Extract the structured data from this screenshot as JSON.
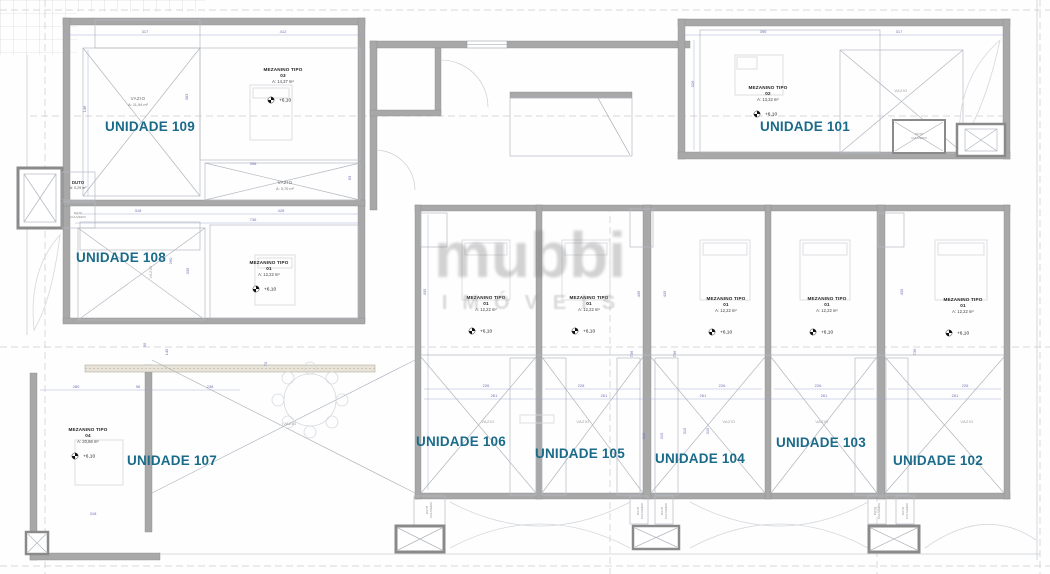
{
  "watermark": {
    "brand": "mubbi",
    "sub": "IMÓVEIS"
  },
  "units": [
    {
      "name": "UNIDADE 109"
    },
    {
      "name": "UNIDADE 101"
    },
    {
      "name": "UNIDADE 108"
    },
    {
      "name": "UNIDADE 107"
    },
    {
      "name": "UNIDADE 106"
    },
    {
      "name": "UNIDADE 105"
    },
    {
      "name": "UNIDADE 104"
    },
    {
      "name": "UNIDADE 103"
    },
    {
      "name": "UNIDADE 102"
    }
  ],
  "mezzanines": [
    {
      "title": "MEZANINO TIPO",
      "num": "03",
      "area": "A: 14,37 m²",
      "level": "+6,10"
    },
    {
      "title": "MEZANINO TIPO",
      "num": "02",
      "area": "A: 13,32 m²",
      "level": "+6,10"
    },
    {
      "title": "MEZANINO TIPO",
      "num": "01",
      "area": "A: 12,22 m²",
      "level": "+6,10"
    },
    {
      "title": "MEZANINO TIPO",
      "num": "04",
      "area": "A: 20,86 m²",
      "level": "+6,10"
    },
    {
      "title": "MEZANINO TIPO",
      "num": "01",
      "area": "A: 12,22 m²",
      "level": "+6,10"
    },
    {
      "title": "MEZANINO TIPO",
      "num": "01",
      "area": "A: 12,22 m²",
      "level": "+6,10"
    },
    {
      "title": "MEZANINO TIPO",
      "num": "01",
      "area": "A: 12,22 m²",
      "level": "+6,10"
    },
    {
      "title": "MEZANINO TIPO",
      "num": "01",
      "area": "A: 12,22 m²",
      "level": "+6,10"
    },
    {
      "title": "MEZANINO TIPO",
      "num": "01",
      "area": "A: 12,22 m²",
      "level": "+6,10"
    }
  ],
  "voids": [
    {
      "label": "VAZIO",
      "area": "A: 11,94 m²"
    },
    {
      "label": "VAZIO",
      "area": "A: 3,70 m²"
    },
    {
      "label": "VAZIO"
    },
    {
      "label": "VAZIO"
    },
    {
      "label": "VAZIO"
    },
    {
      "label": "VAZIO"
    },
    {
      "label": "VAZIO"
    },
    {
      "label": "VAZIO"
    },
    {
      "label": "VAZIO"
    },
    {
      "label": "VAZIO"
    }
  ],
  "shafts": {
    "duto": "DUTO",
    "duto_area": "A: 0,29 m²",
    "ch1": "DUTO",
    "ch2": "CHUVEIRO"
  },
  "dims": [
    "317",
    "412",
    "395",
    "317",
    "398",
    "318",
    "736",
    "428",
    "280",
    "96",
    "238",
    "318",
    "226",
    "261",
    "228",
    "261",
    "226",
    "261",
    "226",
    "261",
    "226",
    "261",
    "146",
    "383",
    "326",
    "260",
    "336",
    "90",
    "145",
    "70",
    "435",
    "435",
    "435",
    "736",
    "736",
    "315",
    "315",
    "435",
    "736",
    "315",
    "315",
    "93"
  ]
}
